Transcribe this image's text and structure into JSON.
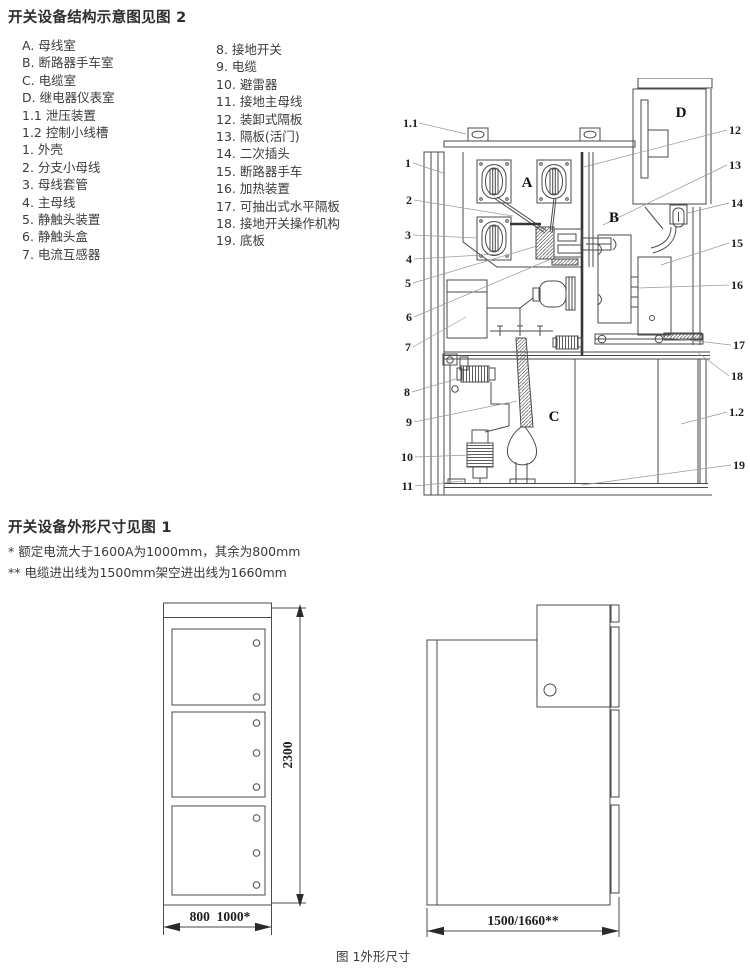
{
  "colors": {
    "background": "#ffffff",
    "ink": "#3a3a3a",
    "line": "#4a4a4a",
    "leader": "#999999"
  },
  "figure2": {
    "title": "开关设备结构示意图见图 2",
    "legend_col1": [
      "A. 母线室",
      "B. 断路器手车室",
      "C. 电缆室",
      "D. 继电器仪表室",
      "1.1 泄压装置",
      "1.2 控制小线槽",
      "1. 外壳",
      "2. 分支小母线",
      "3. 母线套管",
      "4. 主母线",
      "5. 静触头装置",
      "6. 静触头盒",
      "7. 电流互感器"
    ],
    "legend_col2": [
      "8. 接地开关",
      "9. 电缆",
      "10. 避雷器",
      "11. 接地主母线",
      "12. 装卸式隔板",
      "13. 隔板(活门)",
      "14. 二次插头",
      "15. 断路器手车",
      "16. 加热装置",
      "17. 可抽出式水平隔板",
      "18. 接地开关操作机构",
      "19. 底板"
    ],
    "callouts_left": [
      "1.1",
      "1",
      "2",
      "3",
      "4",
      "5",
      "6",
      "7",
      "8",
      "9",
      "10",
      "11"
    ],
    "callouts_right": [
      "12",
      "13",
      "14",
      "15",
      "16",
      "17",
      "18",
      "1.2",
      "19"
    ],
    "compartments": {
      "a": "A",
      "b": "B",
      "c": "C",
      "d": "D"
    }
  },
  "figure1": {
    "title": "开关设备外形尺寸见图 1",
    "notes": [
      "* 额定电流大于1600A为1000mm，其余为800mm",
      "** 电缆进出线为1500mm架空进出线为1660mm"
    ],
    "dim_height": "2300",
    "dim_width_front": "800  1000*",
    "dim_depth": "1500/1660**",
    "caption": "图 1外形尺寸"
  }
}
